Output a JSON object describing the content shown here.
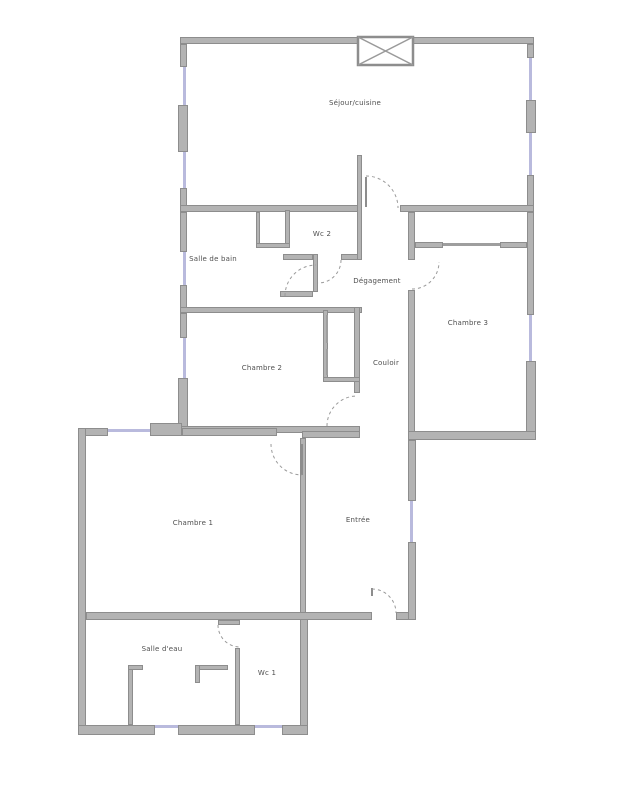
{
  "plan": {
    "title": "apartment-floor-plan",
    "rooms": [
      {
        "id": "sejour-cuisine",
        "label": "Séjour/cuisine"
      },
      {
        "id": "wc-2",
        "label": "Wc 2"
      },
      {
        "id": "salle-de-bain",
        "label": "Salle de bain"
      },
      {
        "id": "degagement",
        "label": "Dégagement"
      },
      {
        "id": "chambre-3",
        "label": "Chambre 3"
      },
      {
        "id": "chambre-2",
        "label": "Chambre 2"
      },
      {
        "id": "couloir",
        "label": "Couloir"
      },
      {
        "id": "chambre-1",
        "label": "Chambre 1"
      },
      {
        "id": "entree",
        "label": "Entrée"
      },
      {
        "id": "salle-deau",
        "label": "Salle d'eau"
      },
      {
        "id": "wc-1",
        "label": "Wc 1"
      }
    ],
    "colors": {
      "wall": "#b3b3b3",
      "wall_border": "#8d8d8d",
      "window_marker": "#b9badd",
      "door_arc": "#9a9a9a",
      "label_text": "#4f4f4f",
      "background": "#ffffff"
    }
  }
}
